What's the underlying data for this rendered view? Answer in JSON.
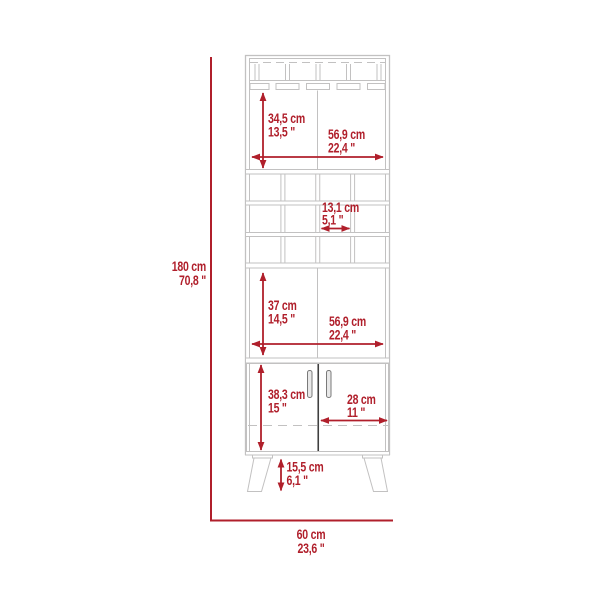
{
  "diagram": {
    "title": "bar-cabinet-dimension-diagram",
    "units": [
      "cm",
      "inches"
    ],
    "colors": {
      "dimension_red": "#b01f2b",
      "cabinet_line_gray": "#c2c1c1",
      "door_gap_dark": "#3f3f3f"
    },
    "features": [
      "stemware-rack",
      "open-display-shelf",
      "wine-cubby-grid-4x3",
      "open-middle-shelf",
      "double-door-cabinet",
      "splayed-legs"
    ]
  },
  "labels": {
    "total_height": {
      "cm": "180 cm",
      "inch": "70,8 \""
    },
    "total_width": {
      "cm": "60 cm",
      "inch": "23,6 \""
    },
    "top_opening_h": {
      "cm": "34,5 cm",
      "inch": "13,5 \""
    },
    "top_opening_w": {
      "cm": "56,9 cm",
      "inch": "22,4 \""
    },
    "cubby_w": {
      "cm": "13,1 cm",
      "inch": "5,1 \""
    },
    "mid_opening_h": {
      "cm": "37 cm",
      "inch": "14,5 \""
    },
    "mid_opening_w": {
      "cm": "56,9 cm",
      "inch": "22,4 \""
    },
    "door_h": {
      "cm": "38,3 cm",
      "inch": "15 \""
    },
    "door_w": {
      "cm": "28 cm",
      "inch": "11 \""
    },
    "leg_h": {
      "cm": "15,5 cm",
      "inch": "6,1 \""
    }
  }
}
